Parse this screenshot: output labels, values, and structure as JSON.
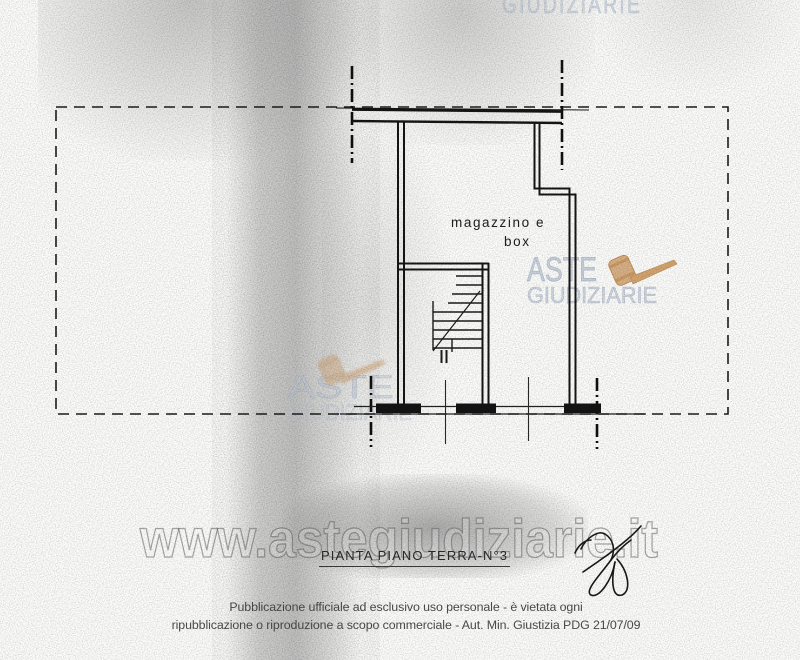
{
  "watermarks": {
    "aste": "ASTE",
    "giudiziarie": "GIUDIZIARIE",
    "url": "www.astegiudiziarie.it",
    "text_color": "#c3cdd9",
    "gavel_color": "#d9b187"
  },
  "plan": {
    "room_label_line1": "magazzino e",
    "room_label_line2": "box",
    "title": "PIANTA PIANO TERRA-N°3"
  },
  "footer": {
    "line1": "Pubblicazione ufficiale ad esclusivo uso personale - è vietata ogni",
    "line2": "ripubblicazione o riproduzione a scopo commerciale - Aut. Min. Giustizia PDG 21/07/09"
  }
}
